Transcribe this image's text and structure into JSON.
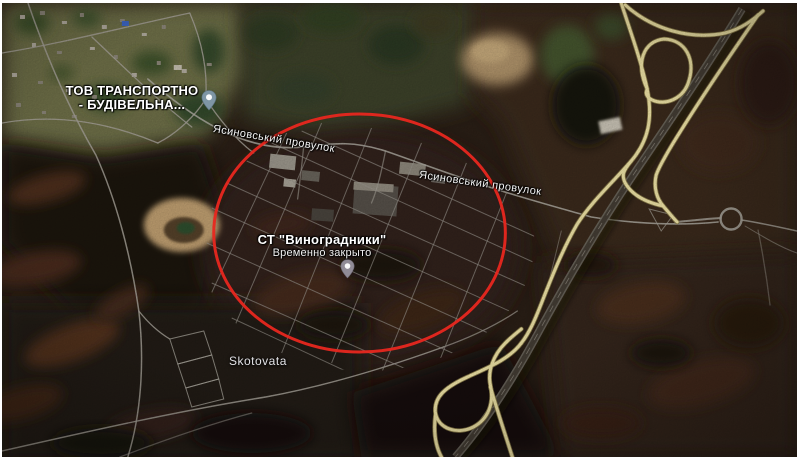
{
  "window": {
    "width": 800,
    "height": 460,
    "view": "satellite"
  },
  "map": {
    "labels": {
      "business": {
        "line1": "ТОВ ТРАНСПОРТНО",
        "line2": "- БУДІВЕЛЬНА..."
      },
      "road1": "Ясиновський провулок",
      "road2": "Ясиновський провулок",
      "site": {
        "name": "СТ \"Виноградники\"",
        "status": "Временно закрыто"
      },
      "settlement": "Skotovata"
    },
    "pins": [
      {
        "id": "business-pin",
        "color": "#7e96a5"
      },
      {
        "id": "site-pin",
        "color": "#908b96"
      }
    ],
    "annotation": {
      "shape": "ellipse",
      "stroke": "#e8271f"
    },
    "road_colors": {
      "ramp_fill": "#f2e6a8",
      "ramp_casing": "#8a7c4a",
      "local": "#a9a59b"
    }
  }
}
